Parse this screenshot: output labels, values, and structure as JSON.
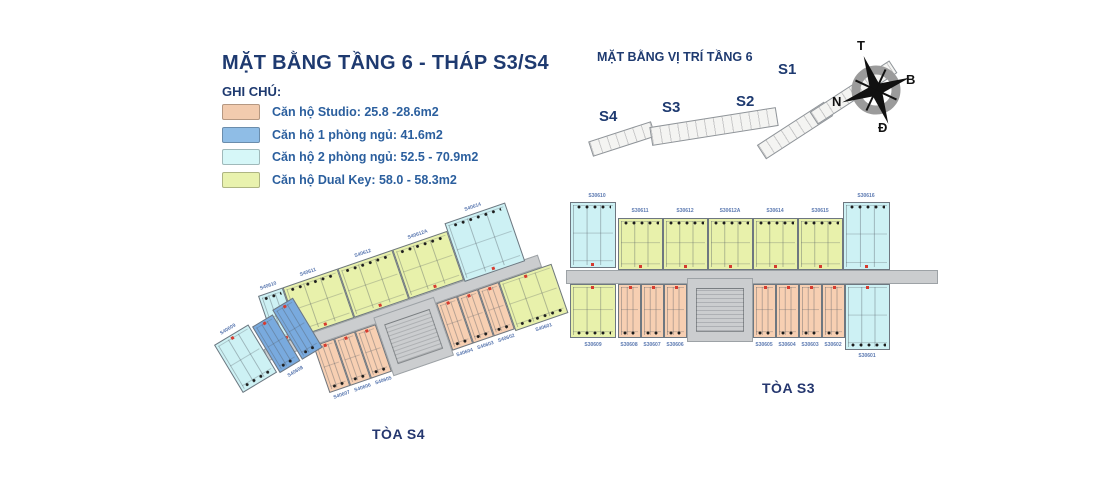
{
  "title": "MẶT BẰNG TẦNG 6 - THÁP S3/S4",
  "legend": {
    "heading": "GHI CHÚ:",
    "items": [
      {
        "label": "Căn hộ Studio: 25.8 -28.6m2",
        "type": "studio",
        "color": "#f2cbae"
      },
      {
        "label": "Căn hộ 1 phòng ngủ: 41.6m2",
        "type": "one-bedroom",
        "color": "#8fbde6"
      },
      {
        "label": "Căn hộ 2 phòng ngủ: 52.5 - 70.9m2",
        "type": "two-bedroom",
        "color": "#d6f7f8"
      },
      {
        "label": "Căn hộ Dual Key: 58.0 - 58.3m2",
        "type": "dual-key",
        "color": "#e9f2ae"
      }
    ]
  },
  "location_plan": {
    "title": "MẶT BẰNG VỊ TRÍ TẦNG 6",
    "tower_labels": [
      "S4",
      "S3",
      "S2",
      "S1"
    ]
  },
  "compass": {
    "top": "T",
    "right": "B",
    "left": "N",
    "bottom": "Đ"
  },
  "buildings": {
    "s4": {
      "caption": "TÒA S4",
      "top_units": [
        {
          "id": "S40610",
          "type": "two-bedroom"
        },
        {
          "id": "S40611",
          "type": "dual-key"
        },
        {
          "id": "S40612",
          "type": "dual-key"
        },
        {
          "id": "S40612A",
          "type": "dual-key"
        },
        {
          "id": "S40614",
          "type": "two-bedroom"
        }
      ],
      "bottom_units": [
        {
          "id": "S40607",
          "type": "studio"
        },
        {
          "id": "S40606",
          "type": "studio"
        },
        {
          "id": "S40605",
          "type": "studio"
        },
        {
          "id": "S40604",
          "type": "studio"
        },
        {
          "id": "S40603",
          "type": "studio"
        },
        {
          "id": "S40602",
          "type": "studio"
        },
        {
          "id": "S40601",
          "type": "dual-key"
        }
      ],
      "wing_units": [
        {
          "id": "S40609",
          "type": "two-bedroom"
        },
        {
          "id": "S40608",
          "type": "one-bedroom"
        }
      ]
    },
    "s3": {
      "caption": "TÒA S3",
      "top_units": [
        {
          "id": "S30610",
          "type": "two-bedroom"
        },
        {
          "id": "S30611",
          "type": "dual-key"
        },
        {
          "id": "S30612",
          "type": "dual-key"
        },
        {
          "id": "S30612A",
          "type": "dual-key"
        },
        {
          "id": "S30614",
          "type": "dual-key"
        },
        {
          "id": "S30615",
          "type": "dual-key"
        },
        {
          "id": "S30616",
          "type": "two-bedroom"
        }
      ],
      "bottom_units": [
        {
          "id": "S30609",
          "type": "dual-key"
        },
        {
          "id": "S30608",
          "type": "studio"
        },
        {
          "id": "S30607",
          "type": "studio"
        },
        {
          "id": "S30606",
          "type": "studio"
        },
        {
          "id": "S30605",
          "type": "studio"
        },
        {
          "id": "S30604",
          "type": "studio"
        },
        {
          "id": "S30603",
          "type": "studio"
        },
        {
          "id": "S30602",
          "type": "studio"
        },
        {
          "id": "S30601",
          "type": "two-bedroom"
        }
      ]
    }
  }
}
